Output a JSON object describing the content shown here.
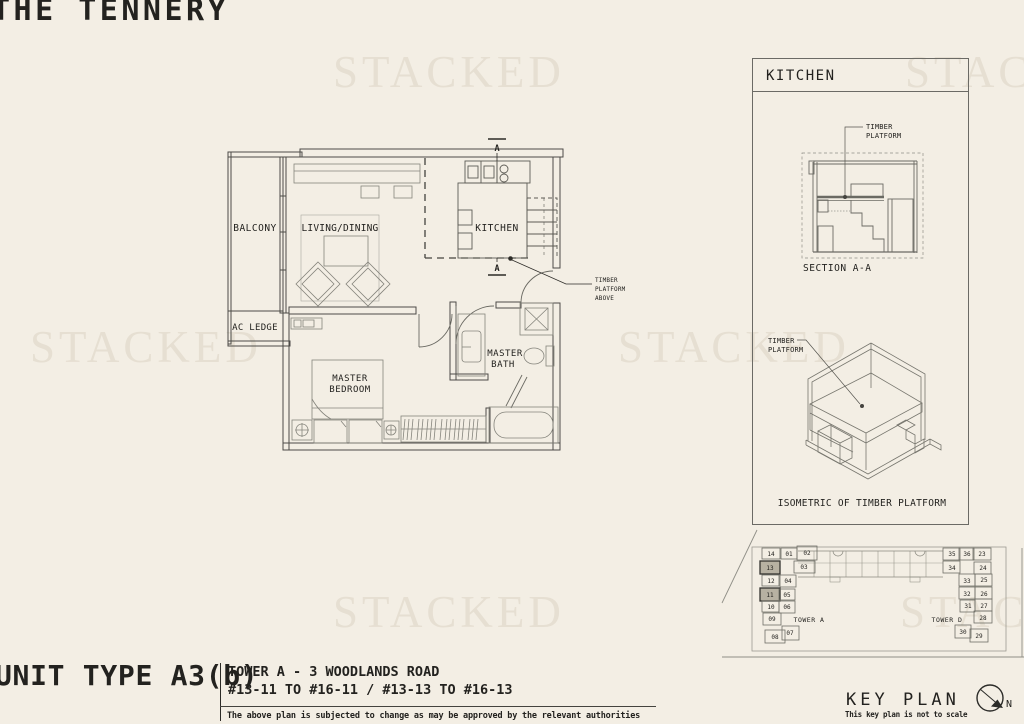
{
  "page": {
    "title": "THE TENNERY",
    "watermark": "STACKED"
  },
  "floor_plan": {
    "rooms": {
      "balcony": "BALCONY",
      "living_dining": "LIVING/DINING",
      "kitchen": "KITCHEN",
      "ac_ledge": "AC LEDGE",
      "master_bedroom_line1": "MASTER",
      "master_bedroom_line2": "BEDROOM",
      "master_bath_line1": "MASTER",
      "master_bath_line2": "BATH"
    },
    "callout": {
      "line1": "TIMBER",
      "line2": "PLATFORM",
      "line3": "ABOVE"
    },
    "section_marker": "A"
  },
  "kitchen_panel": {
    "title": "KITCHEN",
    "section": {
      "callout_line1": "TIMBER",
      "callout_line2": "PLATFORM",
      "caption": "SECTION A-A"
    },
    "isometric": {
      "callout_line1": "TIMBER",
      "callout_line2": "PLATFORM",
      "caption": "ISOMETRIC OF TIMBER PLATFORM"
    }
  },
  "key_plan": {
    "caption": "KEY PLAN",
    "note": "This key plan is not to scale",
    "north_label": "N",
    "highlighted_units": [
      "13",
      "11"
    ],
    "tower_a": {
      "label": "TOWER A",
      "units": [
        "14",
        "01",
        "02",
        "13",
        "03",
        "12",
        "04",
        "11",
        "05",
        "10",
        "06",
        "09",
        "08",
        "07"
      ]
    },
    "tower_d": {
      "label": "TOWER D",
      "units": [
        "35",
        "36",
        "23",
        "34",
        "24",
        "33",
        "25",
        "32",
        "26",
        "31",
        "27",
        "28",
        "30",
        "29"
      ]
    }
  },
  "title_block": {
    "unit_type": "UNIT TYPE A3(b)",
    "address_line1": "TOWER A - 3 WOODLANDS ROAD",
    "address_line2": "#13-11 TO #16-11 / #13-13 TO #16-13",
    "disclaimer": "The above plan is subjected to change as may be approved by the relevant authorities"
  }
}
